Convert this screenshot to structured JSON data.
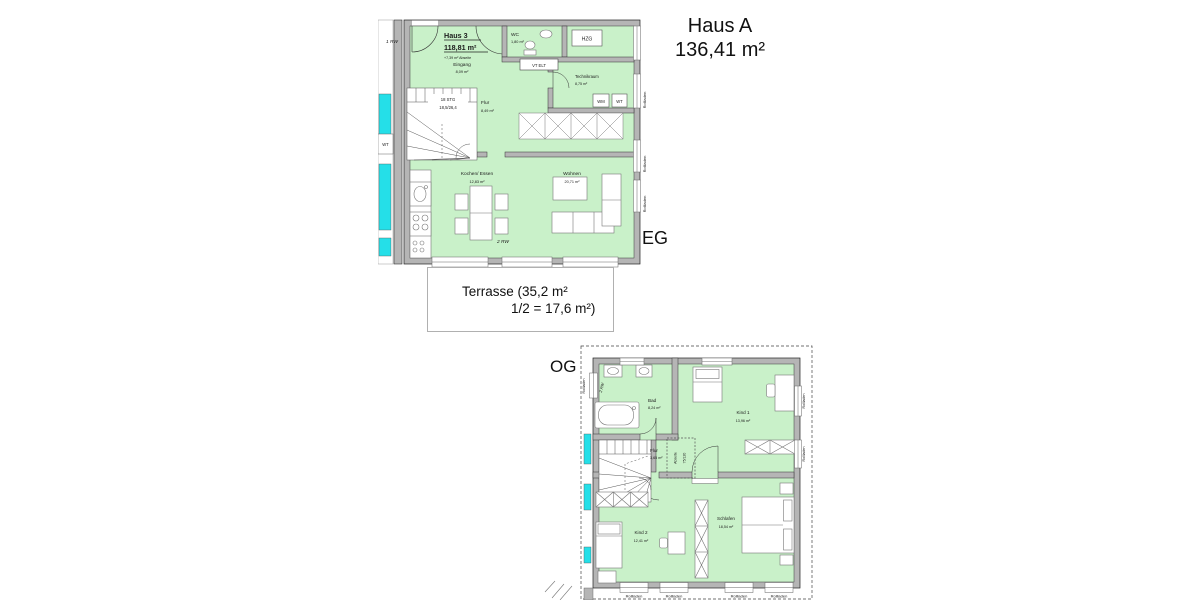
{
  "page": {
    "haus_a_title": "Haus A",
    "haus_a_area": "136,41 m²",
    "eg_label": "EG",
    "og_label": "OG",
    "terrasse_line1": "Terrasse (35,2 m²",
    "terrasse_line2": "1/2 = 17,6 m²)"
  },
  "shared": {
    "rollladen": "Rollladen",
    "rw2": "2 RW"
  },
  "eg": {
    "title": "Haus 3",
    "area": "118,81 m²",
    "note": "+7,39 m² Abseite",
    "rw1": "1 RW",
    "wt_left": "WT",
    "stairs_line1": "18 STG",
    "stairs_line2": "18,5/26,4",
    "vt_elt": "VT ELT",
    "hzg": "HZG",
    "wm": "WM",
    "wt": "WT",
    "rooms": {
      "eingang": {
        "name": "Eingang",
        "area": "8,09 m²"
      },
      "wc": {
        "name": "WC",
        "area": "1,80 m²"
      },
      "technikraum": {
        "name": "Technikraum",
        "area": "8,75 m²"
      },
      "flur": {
        "name": "Flur",
        "area": "8,49 m²"
      },
      "kochen": {
        "name": "Kochen/ Essen",
        "area": "12,83 m²"
      },
      "wohnen": {
        "name": "Wohnen",
        "area": "20,71 m²"
      }
    }
  },
  "og": {
    "abseite_line1": "Abseite",
    "abseite_line2": "75/120",
    "rooms": {
      "bad": {
        "name": "Bad",
        "area": "8,24 m²"
      },
      "kind1": {
        "name": "Kind 1",
        "area": "13,96 m²"
      },
      "flur": {
        "name": "Flur",
        "area": "3,65 m²"
      },
      "kind2": {
        "name": "Kind 2",
        "area": "12,41 m²"
      },
      "schlafen": {
        "name": "Schlafen",
        "area": "18,54 m²"
      }
    }
  },
  "colors": {
    "room_fill": "#c9f1c9",
    "wall_fill": "#b5b5b5",
    "neighbor_cyan": "#25dfe8",
    "line": "#3c3c3c"
  }
}
